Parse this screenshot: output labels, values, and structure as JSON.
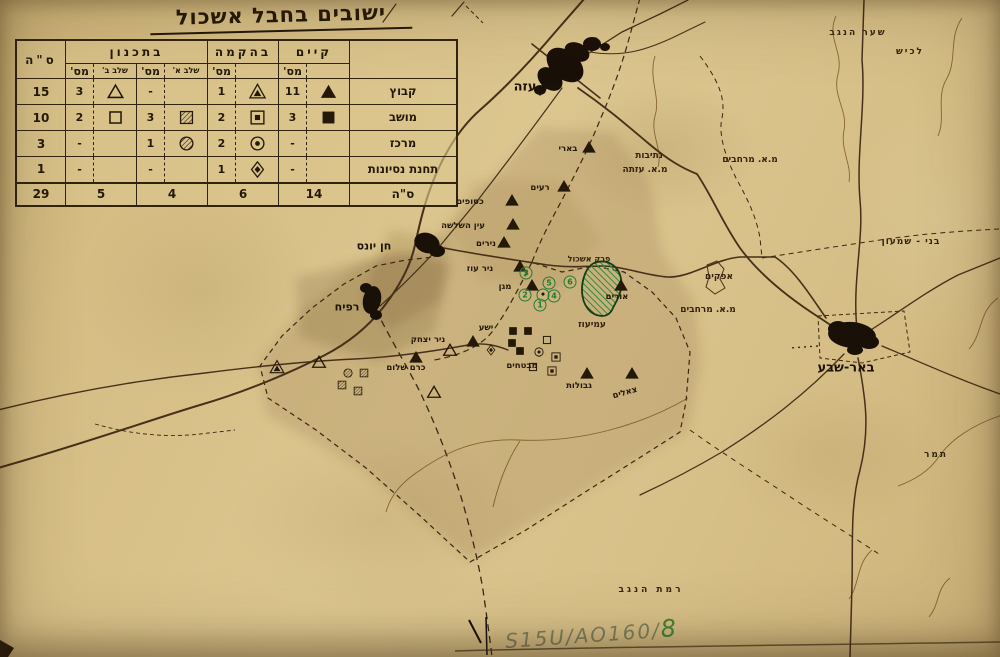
{
  "title": {
    "text": "ישובים בחבל אשכול"
  },
  "colors": {
    "paper": "#d5bd84",
    "ink": "#241808",
    "road": "#46301a",
    "green_ink": "#257a33",
    "pencil": "#7d8160"
  },
  "legend_table": {
    "groups": {
      "existing": "קיים",
      "under_construction": "בהקמה",
      "planned": "בתכנון",
      "total": "ס\"ה"
    },
    "subheaders": {
      "num": "מס'",
      "stage_a": "שלב א'",
      "stage_b": "שלב ב'"
    },
    "rows": [
      {
        "label": "קבוץ",
        "cells": [
          {
            "sym": "triangle-filled",
            "n": "11"
          },
          {
            "sym": "triangle-ring",
            "n": "1"
          },
          {
            "sym": "none",
            "n": "-"
          },
          {
            "sym": "triangle-empty",
            "n": "3"
          }
        ],
        "total": "15"
      },
      {
        "label": "מושב",
        "cells": [
          {
            "sym": "square-filled",
            "n": "3"
          },
          {
            "sym": "square-ring",
            "n": "2"
          },
          {
            "sym": "square-hatched",
            "n": "3"
          },
          {
            "sym": "square-empty",
            "n": "2"
          }
        ],
        "total": "10"
      },
      {
        "label": "מרכז",
        "cells": [
          {
            "sym": "none",
            "n": "-"
          },
          {
            "sym": "circle-ring",
            "n": "2"
          },
          {
            "sym": "circle-hatched",
            "n": "1"
          },
          {
            "sym": "none",
            "n": "-"
          }
        ],
        "total": "3"
      },
      {
        "label": "תחנת נסיונות",
        "cells": [
          {
            "sym": "none",
            "n": "-"
          },
          {
            "sym": "diamond-ring",
            "n": "1"
          },
          {
            "sym": "none",
            "n": "-"
          },
          {
            "sym": "none",
            "n": "-"
          }
        ],
        "total": "1"
      }
    ],
    "totals": {
      "label": "ס\"ה",
      "existing": "14",
      "under_construction": "6",
      "stage_a": "4",
      "stage_b": "5",
      "grand": "29"
    }
  },
  "map": {
    "labels": [
      {
        "t": "עזה",
        "kind": "city",
        "x": 525,
        "y": 87,
        "fs": 13
      },
      {
        "t": "חן יונס",
        "kind": "city",
        "x": 374,
        "y": 246,
        "fs": 11
      },
      {
        "t": "רפיח",
        "kind": "city",
        "x": 347,
        "y": 307,
        "fs": 11
      },
      {
        "t": "באר-שבע",
        "kind": "city",
        "x": 846,
        "y": 368,
        "fs": 13
      },
      {
        "t": "שער הנגב",
        "kind": "area",
        "x": 858,
        "y": 33,
        "fs": 9,
        "ls": 2
      },
      {
        "t": "לכיש",
        "kind": "area",
        "x": 910,
        "y": 52,
        "fs": 9,
        "ls": 2
      },
      {
        "t": "נתיבות",
        "kind": "area",
        "x": 649,
        "y": 156,
        "fs": 9
      },
      {
        "t": "מ.א. עזתה",
        "kind": "area",
        "x": 645,
        "y": 170,
        "fs": 9
      },
      {
        "t": "מ.א. מרחבים",
        "kind": "area",
        "x": 750,
        "y": 160,
        "fs": 9
      },
      {
        "t": "אפקים",
        "kind": "area",
        "x": 719,
        "y": 277,
        "fs": 9
      },
      {
        "t": "מ.א. מרחבים",
        "kind": "area",
        "x": 708,
        "y": 310,
        "fs": 9
      },
      {
        "t": "בני - שמעון",
        "kind": "area",
        "x": 911,
        "y": 242,
        "fs": 9,
        "ls": 1
      },
      {
        "t": "פרק אשכול",
        "kind": "area",
        "x": 589,
        "y": 259,
        "fs": 8
      },
      {
        "t": "עמיעוז",
        "kind": "area",
        "x": 592,
        "y": 325,
        "fs": 9
      },
      {
        "t": "תמר",
        "kind": "area",
        "x": 936,
        "y": 455,
        "fs": 9,
        "ls": 2
      },
      {
        "t": "רמת הנגב",
        "kind": "area",
        "x": 651,
        "y": 590,
        "fs": 9,
        "ls": 3
      },
      {
        "t": "בארי",
        "kind": "settlement",
        "x": 568,
        "y": 149,
        "fs": 8.5
      },
      {
        "t": "רעים",
        "kind": "settlement",
        "x": 540,
        "y": 188,
        "fs": 8.5
      },
      {
        "t": "כסופים",
        "kind": "settlement",
        "x": 470,
        "y": 202,
        "fs": 8.5
      },
      {
        "t": "עין השלשה",
        "kind": "settlement",
        "x": 463,
        "y": 226,
        "fs": 8.5
      },
      {
        "t": "נירים",
        "kind": "settlement",
        "x": 486,
        "y": 244,
        "fs": 8.5
      },
      {
        "t": "ניר עוז",
        "kind": "settlement",
        "x": 480,
        "y": 269,
        "fs": 8.5
      },
      {
        "t": "מגן",
        "kind": "settlement",
        "x": 505,
        "y": 287,
        "fs": 8.5
      },
      {
        "t": "אורים",
        "kind": "settlement",
        "x": 617,
        "y": 297,
        "fs": 8.5
      },
      {
        "t": "ישע",
        "kind": "settlement",
        "x": 486,
        "y": 328,
        "fs": 8.5
      },
      {
        "t": "מבטחים",
        "kind": "settlement",
        "x": 522,
        "y": 366,
        "fs": 8.5
      },
      {
        "t": "גבולות",
        "kind": "settlement",
        "x": 579,
        "y": 386,
        "fs": 8.5
      },
      {
        "t": "צאלים",
        "kind": "settlement",
        "x": 625,
        "y": 393,
        "fs": 8.5,
        "rot": -16
      },
      {
        "t": "ניר יצחק",
        "kind": "settlement",
        "x": 428,
        "y": 340,
        "fs": 8.5
      },
      {
        "t": "כרם שלום",
        "kind": "settlement",
        "x": 406,
        "y": 368,
        "fs": 8.5
      }
    ],
    "markers": [
      {
        "sym": "triangle-filled",
        "x": 589,
        "y": 147
      },
      {
        "sym": "triangle-filled",
        "x": 564,
        "y": 186
      },
      {
        "sym": "triangle-filled",
        "x": 512,
        "y": 200
      },
      {
        "sym": "triangle-filled",
        "x": 513,
        "y": 224
      },
      {
        "sym": "triangle-filled",
        "x": 504,
        "y": 242
      },
      {
        "sym": "triangle-filled",
        "x": 520,
        "y": 266
      },
      {
        "sym": "triangle-filled",
        "x": 532,
        "y": 285
      },
      {
        "sym": "triangle-filled",
        "x": 621,
        "y": 285
      },
      {
        "sym": "triangle-filled",
        "x": 473,
        "y": 341
      },
      {
        "sym": "triangle-filled",
        "x": 416,
        "y": 357
      },
      {
        "sym": "triangle-filled",
        "x": 587,
        "y": 373
      },
      {
        "sym": "triangle-filled",
        "x": 632,
        "y": 373
      },
      {
        "sym": "triangle-empty",
        "x": 450,
        "y": 350
      },
      {
        "sym": "triangle-empty",
        "x": 434,
        "y": 392
      },
      {
        "sym": "triangle-empty",
        "x": 319,
        "y": 362
      },
      {
        "sym": "triangle-ring",
        "x": 277,
        "y": 367
      },
      {
        "sym": "circle-hatched",
        "x": 348,
        "y": 373
      },
      {
        "sym": "square-hatched",
        "x": 364,
        "y": 373
      },
      {
        "sym": "square-hatched",
        "x": 342,
        "y": 385
      },
      {
        "sym": "square-hatched",
        "x": 358,
        "y": 391
      },
      {
        "sym": "diamond-ring",
        "x": 491,
        "y": 350
      },
      {
        "sym": "square-filled",
        "x": 513,
        "y": 331
      },
      {
        "sym": "square-filled",
        "x": 528,
        "y": 331
      },
      {
        "sym": "square-filled",
        "x": 512,
        "y": 343
      },
      {
        "sym": "square-filled",
        "x": 520,
        "y": 351
      },
      {
        "sym": "square-empty",
        "x": 547,
        "y": 340
      },
      {
        "sym": "circle-ring",
        "x": 539,
        "y": 352
      },
      {
        "sym": "square-ring",
        "x": 556,
        "y": 357
      },
      {
        "sym": "square-empty",
        "x": 533,
        "y": 367
      },
      {
        "sym": "square-ring",
        "x": 552,
        "y": 371
      }
    ],
    "green_numbers": [
      {
        "n": "1",
        "x": 540,
        "y": 305
      },
      {
        "n": "2",
        "x": 525,
        "y": 295
      },
      {
        "n": "3",
        "x": 526,
        "y": 273
      },
      {
        "n": "4",
        "x": 554,
        "y": 296
      },
      {
        "n": "5",
        "x": 549,
        "y": 283
      },
      {
        "n": "6",
        "x": 570,
        "y": 282
      },
      {
        "n": "•",
        "x": 543,
        "y": 295
      }
    ]
  },
  "annotation": {
    "handwritten": "S15U/AO160/",
    "suffix": "8"
  }
}
